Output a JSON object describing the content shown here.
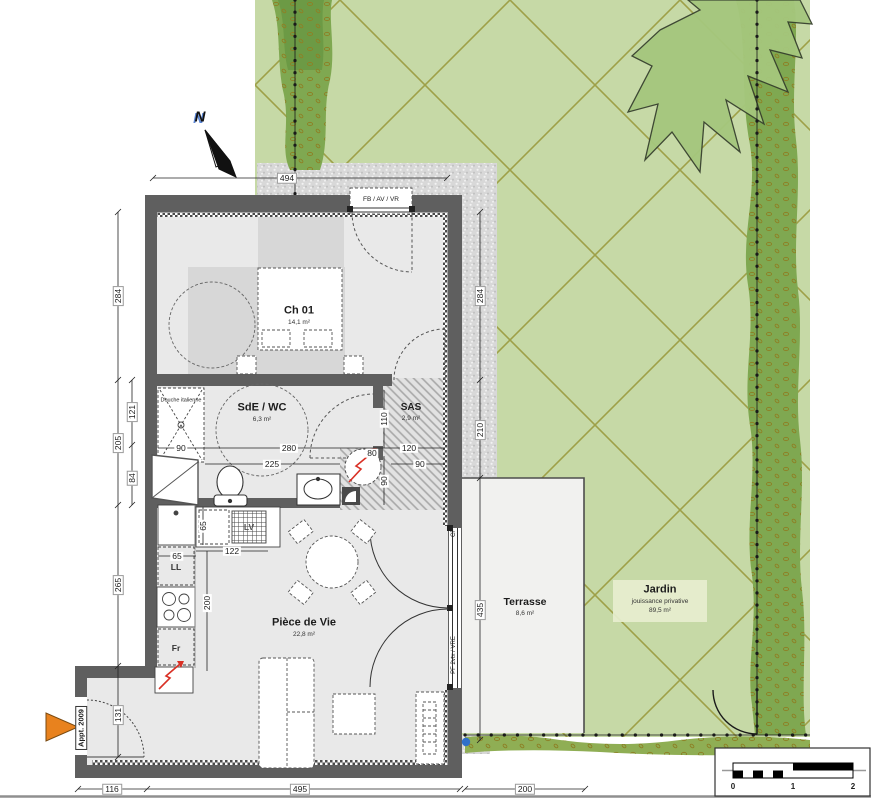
{
  "plan": {
    "north_label": "N",
    "apartment_tag": "Appt. 2009"
  },
  "rooms": {
    "ch01": {
      "name": "Ch 01",
      "area": "14,1 m²"
    },
    "sde": {
      "name": "SdE / WC",
      "area": "6,3 m²"
    },
    "sas": {
      "name": "SAS",
      "area": "2,9 m²"
    },
    "vie": {
      "name": "Pièce de Vie",
      "area": "22,8 m²"
    },
    "terrasse": {
      "name": "Terrasse",
      "area": "8,6 m²"
    },
    "jardin": {
      "name": "Jardin",
      "subtitle": "jouissance privative",
      "area": "89,5 m²"
    }
  },
  "annotations": {
    "window_top": "FB / AV / VR",
    "window_right_top": "CF",
    "window_right": "PF 2vtx / VRE",
    "shower": "Douche italienne",
    "washer": "LL",
    "fridge": "Fr",
    "dishwasher": "LV"
  },
  "dimensions": {
    "top_494": "494",
    "left_284": "284",
    "left_205": "205",
    "left_121": "121",
    "left_84": "84",
    "left_265": "265",
    "left_131": "131",
    "bottom_116": "116",
    "bottom_495": "495",
    "bottom_200": "200",
    "right_284": "284",
    "right_210": "210",
    "right_435": "435",
    "shower_90": "90",
    "sde_280": "280",
    "sde_225": "225",
    "sas_110": "110",
    "sas_120": "120",
    "ce_80": "80",
    "pass_90": "90",
    "pass_90b": "90",
    "kitchen_65v": "65",
    "kitchen_65h": "65",
    "kitchen_122": "122",
    "kitchen_200": "200"
  },
  "scalebar": {
    "n0": "0",
    "n1": "1",
    "n2": "2"
  },
  "colors": {
    "garden_green": "#c6d9a6",
    "hedge_green": "#7fa851",
    "tree_green": "#a5c77d",
    "line_olive": "#9a9a3d",
    "wall_gray": "#5f5f5f",
    "floor_gray": "#e9e9e9",
    "accent_red": "#d93025",
    "arrow_orange": "#e8821e",
    "marker_blue": "#2f6fc9"
  }
}
